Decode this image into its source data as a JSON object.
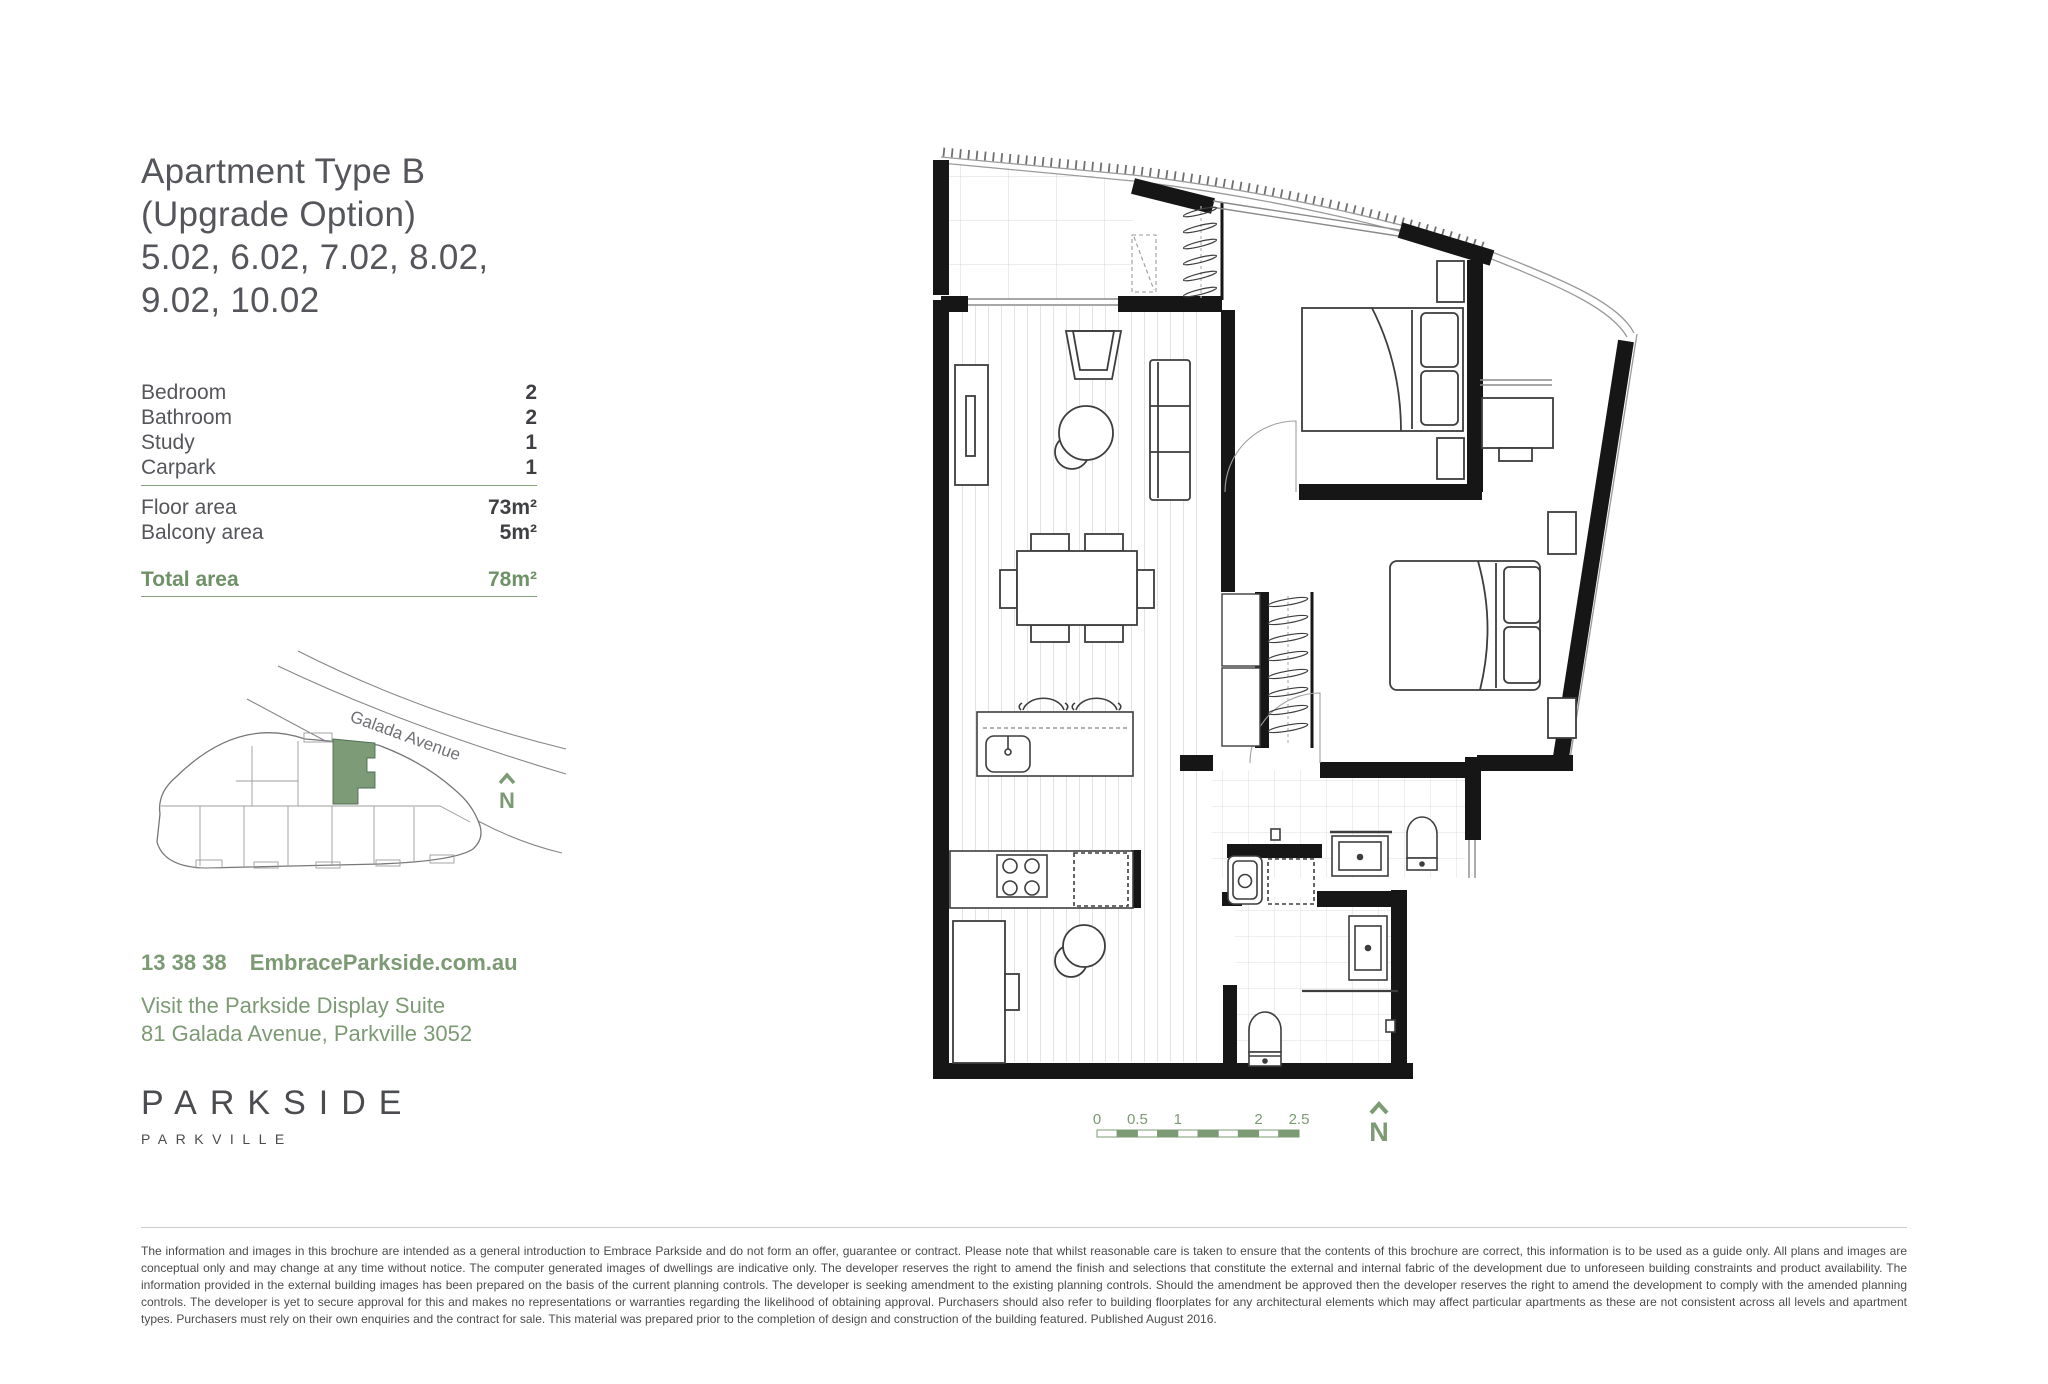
{
  "title": {
    "lines": [
      "Apartment Type B",
      "(Upgrade Option)",
      "5.02, 6.02, 7.02, 8.02,",
      "9.02, 10.02"
    ]
  },
  "specs": {
    "rooms": [
      {
        "label": "Bedroom",
        "value": "2"
      },
      {
        "label": "Bathroom",
        "value": "2"
      },
      {
        "label": "Study",
        "value": "1"
      },
      {
        "label": "Carpark",
        "value": "1"
      }
    ],
    "areas": [
      {
        "label": "Floor area",
        "value": "73m²"
      },
      {
        "label": "Balcony area",
        "value": "5m²"
      }
    ],
    "total": {
      "label": "Total area",
      "value": "78m²"
    }
  },
  "site_map": {
    "street_label": "Galada Avenue",
    "north_label": "N"
  },
  "contact": {
    "phone": "13 38 38",
    "website": "EmbraceParkside.com.au",
    "line1": "Visit the Parkside Display Suite",
    "line2": "81 Galada Avenue, Parkville 3052"
  },
  "logo": {
    "name": "PARKSIDE",
    "subtitle": "PARKVILLE"
  },
  "floorplan": {
    "scale_labels": [
      "0",
      "0.5",
      "1",
      "2",
      "2.5"
    ],
    "north_label": "N"
  },
  "colors": {
    "text_gray": "#55565b",
    "accent_green": "#7c9a74",
    "map_unit_green": "#7e9b78",
    "wall_black": "#161616"
  },
  "disclaimer": "The information and images in this brochure are intended as a general introduction to Embrace Parkside and do not form an offer, guarantee or contract. Please note that whilst reasonable care is taken to ensure that the contents of this brochure are correct, this information is to be used as a guide only. All plans and images are conceptual only and may change at any time without notice. The computer generated images of dwellings are indicative only. The developer reserves the right to amend the finish and selections that constitute the external and internal fabric of the development due to unforeseen building constraints and product availability. The information provided in the external building images has been prepared on the basis of the current planning controls. The developer is seeking amendment to the existing planning controls. Should the amendment be approved then the developer reserves the right to amend the development to comply with the amended planning controls. The developer is yet to secure approval for this and makes no representations or warranties regarding the likelihood of obtaining approval. Purchasers should also refer to building floorplates for any architectural elements which may affect particular apartments as these are not consistent across all levels and apartment types. Purchasers must rely on their own enquiries and the contract for sale. This material was prepared prior to the completion of design and construction of the building featured. Published August 2016."
}
